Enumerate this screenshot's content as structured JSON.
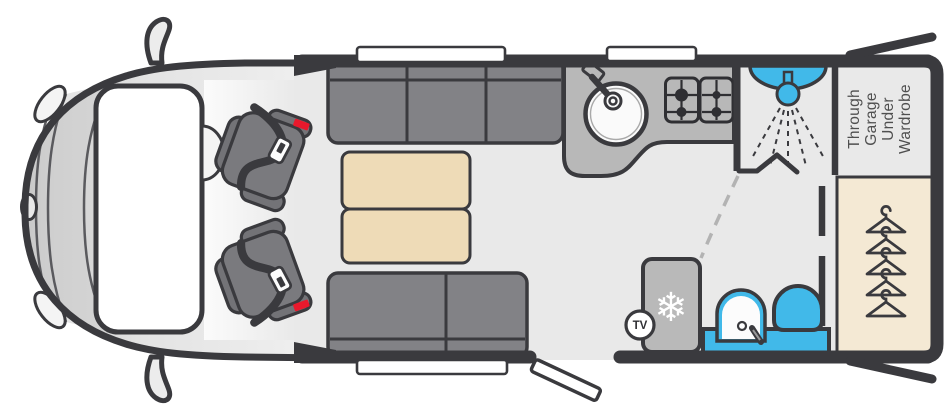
{
  "floorplan": {
    "type": "motorhome-overhead-floorplan",
    "labels": {
      "tv": "TV",
      "garage": [
        "Through",
        "Garage",
        "Under",
        "Wardrobe"
      ]
    },
    "icons": {
      "fridge": "snowflake",
      "snowflake_glyph": "❄",
      "wardrobe": "coat-hangers",
      "shower": "shower-head",
      "kitchen": [
        "sink",
        "gas-hob"
      ],
      "washroom": [
        "washbasin",
        "toilet"
      ],
      "cab": [
        "wing-mirror",
        "headlight",
        "windscreen",
        "seatbelt-buckle"
      ]
    },
    "wardrobe": {
      "hanger_count": 5
    },
    "features": {
      "windows_top": 2,
      "windows_bottom": 1,
      "swivel_seats": 2,
      "sofa_segments_top": 3,
      "sofa_segments_bottom": 2,
      "hob_burners": 4,
      "doors_open": 3
    },
    "colors": {
      "wall": "#3a3a3e",
      "floor": "#e9e9e9",
      "fixture_blue": "#41b9e9",
      "seatbelt_red": "#e8192c",
      "sofa_gray": "#828286",
      "counter_gray": "#b8b8b8",
      "table_beige": "#eedbb7",
      "wardrobe_beige": "#f4e9d4"
    }
  }
}
